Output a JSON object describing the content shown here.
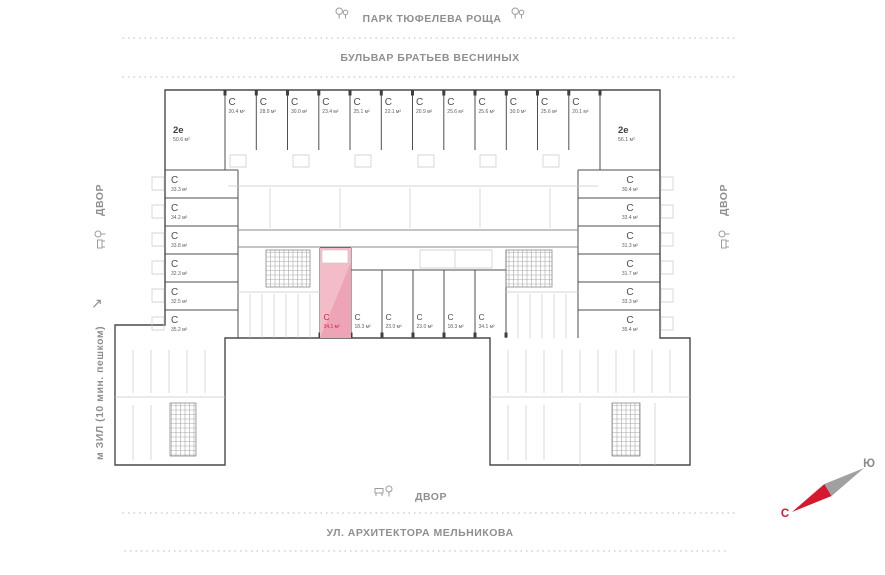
{
  "labels": {
    "park": "ПАРК ТЮФЕЛЕВА РОЩА",
    "boulevard": "БУЛЬВАР БРАТЬЕВ ВЕСНИНЫХ",
    "street": "УЛ. АРХИТЕКТОРА МЕЛЬНИКОВА",
    "yard_left": "ДВОР",
    "yard_right": "ДВОР",
    "yard_bottom": "ДВОР",
    "metro": "м ЗИЛ (10 мин. пешком)",
    "metro_arrow": "↗"
  },
  "compass": {
    "north_label": "С",
    "south_label": "Ю"
  },
  "colors": {
    "accent_red": "#d91f3e",
    "selected_fill": "#f4bcc7",
    "selected_fill_dark": "#eda4b4",
    "compass_red": "#d6182f",
    "compass_gray": "#a0a0a0",
    "wall_dark": "#4a4a4a",
    "wall_light": "#c8c8c8"
  },
  "selected_unit": {
    "type": "С",
    "area": "34.1 м²"
  },
  "units": {
    "top": [
      {
        "type": "2е",
        "area": "50.6 м²"
      },
      {
        "type": "С",
        "area": "20.4 м²"
      },
      {
        "type": "С",
        "area": "28.9 м²"
      },
      {
        "type": "С",
        "area": "30.0 м²"
      },
      {
        "type": "С",
        "area": "23.4 м²"
      },
      {
        "type": "С",
        "area": "25.1 м²"
      },
      {
        "type": "С",
        "area": "22.1 м²"
      },
      {
        "type": "С",
        "area": "20.9 м²"
      },
      {
        "type": "С",
        "area": "25.6 м²"
      },
      {
        "type": "С",
        "area": "25.6 м²"
      },
      {
        "type": "С",
        "area": "30.0 м²"
      },
      {
        "type": "С",
        "area": "25.6 м²"
      },
      {
        "type": "С",
        "area": "20.1 м²"
      },
      {
        "type": "2е",
        "area": "56.1 м²"
      }
    ],
    "left": [
      {
        "type": "С",
        "area": "33.3 м²"
      },
      {
        "type": "С",
        "area": "34.2 м²"
      },
      {
        "type": "С",
        "area": "33.8 м²"
      },
      {
        "type": "С",
        "area": "32.3 м²"
      },
      {
        "type": "С",
        "area": "32.5 м²"
      },
      {
        "type": "С",
        "area": "35.2 м²"
      }
    ],
    "right": [
      {
        "type": "С",
        "area": "30.4 м²"
      },
      {
        "type": "С",
        "area": "33.4 м²"
      },
      {
        "type": "С",
        "area": "31.3 м²"
      },
      {
        "type": "С",
        "area": "31.7 м²"
      },
      {
        "type": "С",
        "area": "33.3 м²"
      },
      {
        "type": "С",
        "area": "35.4 м²"
      }
    ],
    "middle": [
      {
        "type": "С",
        "area": "34.1 м²",
        "selected": true
      },
      {
        "type": "С",
        "area": "18.3 м²"
      },
      {
        "type": "С",
        "area": "23.0 м²"
      },
      {
        "type": "С",
        "area": "23.0 м²"
      },
      {
        "type": "С",
        "area": "18.3 м²"
      },
      {
        "type": "С",
        "area": "34.1 м²"
      }
    ]
  }
}
